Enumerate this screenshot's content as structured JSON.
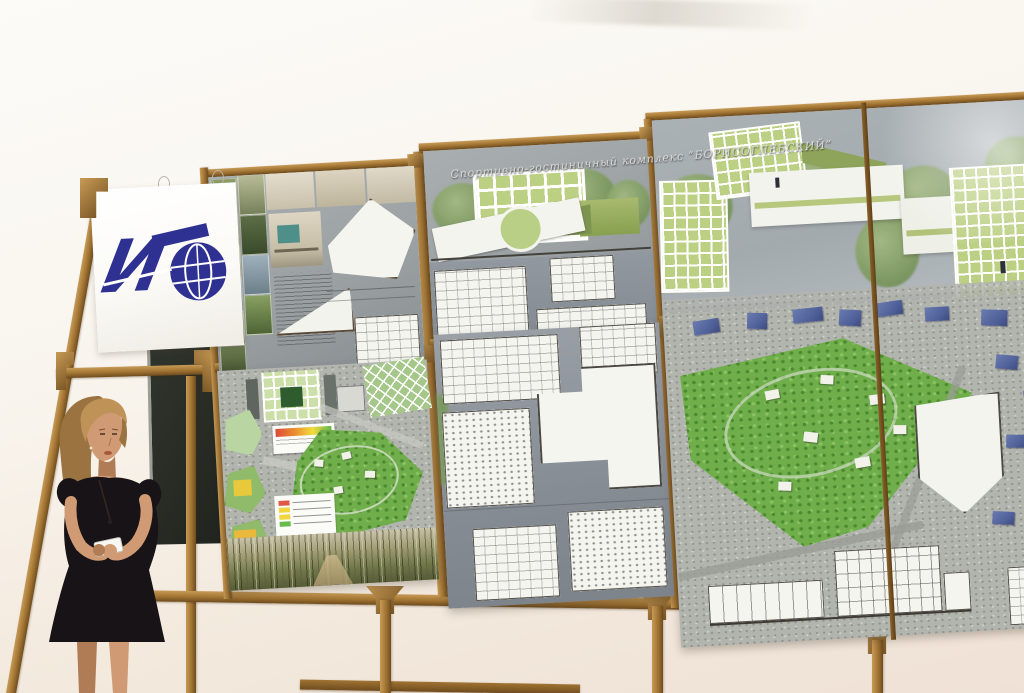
{
  "scene": {
    "caption": "Presenter standing beside wooden exhibition frames holding six architectural project boards",
    "board_title": "Спортивно-гостиничный комплекс “БОРИСОГЛЕБСКИЙ”",
    "logo_letter": "И"
  },
  "legend_gradient": [
    "#dc4a38",
    "#ea8c2e",
    "#f2dc3e",
    "#62b84a"
  ],
  "legend_rows": [
    "#e05747",
    "#f2d640",
    "#f2d640",
    "#66bb4a"
  ],
  "colors": {
    "wall_top": "#fcfbf8",
    "wall_bottom": "#efe1d5",
    "wood_light": "#c79a55",
    "wood": "#a07332",
    "wood_dark": "#6f4c1e",
    "board_gray": "#9ba1a3",
    "board_gray_dark": "#878d90",
    "logo_blue": "#2e3192",
    "chalkboard": "#272b24",
    "skin": "#d09a74",
    "skin_shade": "#b07c55",
    "hair": "#bf9257",
    "hair_dark": "#9a7340",
    "dress": "#181317",
    "paper": "#f7f7f3",
    "park_green": "#6fae4a",
    "park_dark": "#4c8a30",
    "glass_green": "#bcd084",
    "facade_white": "#f4f5ef",
    "city_blue": "#51629b",
    "sky_gray": "#a3aaae",
    "title_text": "#d8d8d5"
  }
}
